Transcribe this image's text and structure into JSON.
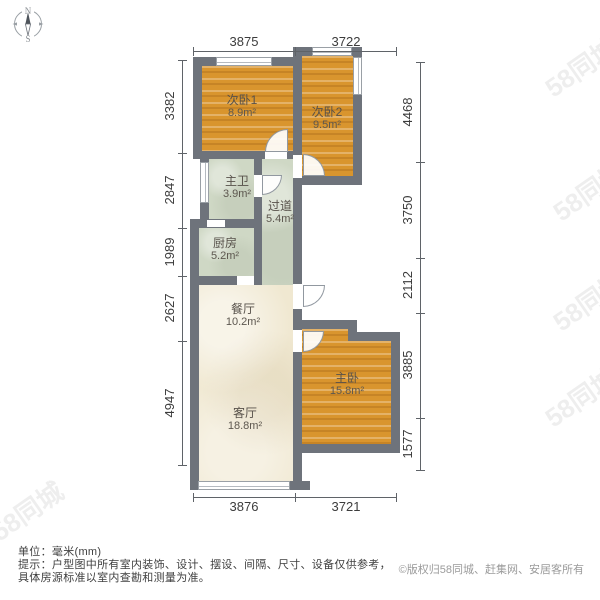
{
  "compass": {
    "north": "N",
    "south": "S"
  },
  "plan": {
    "rooms": [
      {
        "name": "次卧1",
        "area": "8.9m²"
      },
      {
        "name": "次卧2",
        "area": "9.5m²"
      },
      {
        "name": "主卫",
        "area": "3.9m²"
      },
      {
        "name": "过道",
        "area": "5.4m²"
      },
      {
        "name": "厨房",
        "area": "5.2m²"
      },
      {
        "name": "餐厅",
        "area": "10.2m²"
      },
      {
        "name": "客厅",
        "area": "18.8m²"
      },
      {
        "name": "主卧",
        "area": "15.8m²"
      }
    ],
    "dimensions": {
      "top": [
        "3875",
        "3722"
      ],
      "bottom": [
        "3876",
        "3721"
      ],
      "left": [
        "3382",
        "2847",
        "1989",
        "2627",
        "4947"
      ],
      "right": [
        "4468",
        "3750",
        "2112",
        "3885",
        "1577"
      ]
    }
  },
  "watermark": {
    "text": "58同城"
  },
  "footer": {
    "unit": "单位：毫米(mm)",
    "tip1": "提示：户型图中所有室内装饰、设计、摆设、间隔、尺寸、设备仅供参考，",
    "tip2": "具体房源标准以室内查勘和测量为准。",
    "copyright": "©版权归58同城、赶集网、安居客所有"
  },
  "colors": {
    "wall": "#6e737b",
    "wood": "#d9952e",
    "tile": "#cfd8c5",
    "marble": "#f0e8d1"
  }
}
